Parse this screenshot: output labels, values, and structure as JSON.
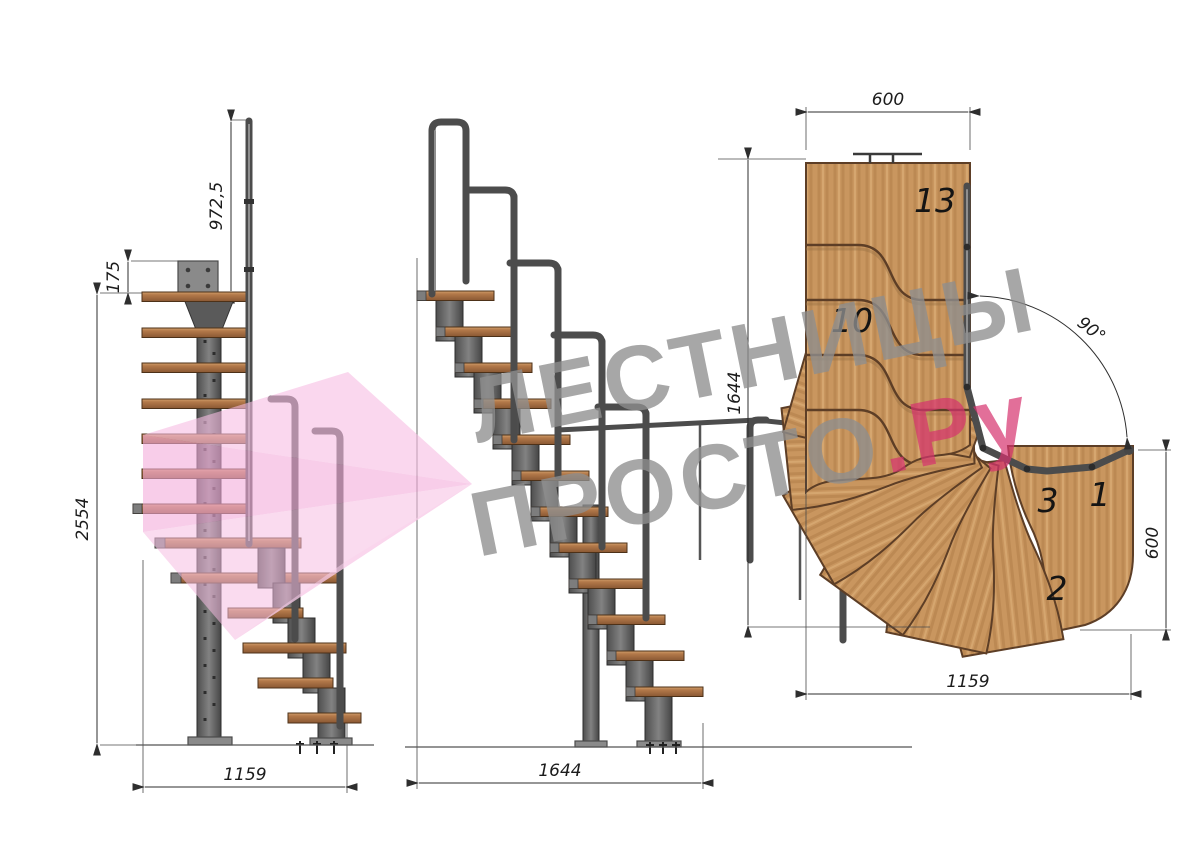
{
  "drawing": {
    "side_view": {
      "dim_rail_height": "972,5",
      "dim_plate_offset": "175",
      "dim_total_height": "2554",
      "dim_depth": "1159"
    },
    "front_view": {
      "dim_width": "1644"
    },
    "plan_view": {
      "dim_top_width": "600",
      "dim_left_height": "1644",
      "dim_bottom_width": "1159",
      "dim_right_height": "600",
      "dim_turn_angle": "90°",
      "steps": {
        "s13": "13",
        "s10": "10",
        "s3": "3",
        "s2": "2",
        "s1": "1"
      }
    }
  },
  "watermark": {
    "line1": "ЛЕСТНИЦЫ",
    "line2_gray": "ПРОСТО",
    "line2_pink": ".Ру"
  },
  "colors": {
    "wood_plan": "#c9965f",
    "wood_elevation": "#b3794a",
    "steel": "#6a6a6a",
    "dimension": "#2e2e2e",
    "watermark_gray": "#8f8f8f",
    "watermark_pink": "#d6336f",
    "logo_pink": "#f3abdb"
  }
}
